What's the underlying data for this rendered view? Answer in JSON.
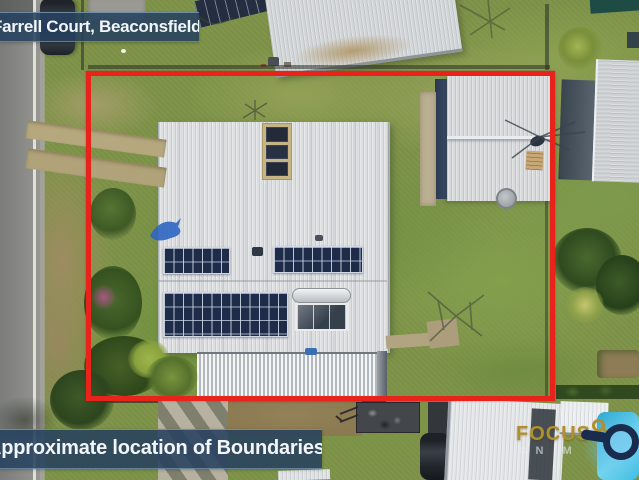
{
  "overlays": {
    "location_banner": {
      "text": "Farrell Court, Beaconsfield"
    },
    "boundary_banner": {
      "text": "Approximate location of Boundaries"
    },
    "boundary_box": {
      "color": "#e8231c"
    }
  },
  "watermark": {
    "brand": "FOCUS",
    "tagline_visible": "ON M",
    "brand_color": "#b0902d",
    "icon": "magnifying-glass-icon",
    "icon_colors": {
      "ring": "#1a2c4e",
      "lens": "#82cdf0",
      "accent": "#b0902d"
    }
  },
  "scene": {
    "type": "aerial-drone-photo",
    "palette": {
      "grass": "#7e9348",
      "road": "#8a8b88",
      "main_roof": "#dcdee0",
      "solar_panels": "#1e2c49",
      "pool": "#3ab4de"
    },
    "features": [
      "road",
      "parked-car",
      "main-house-roof",
      "solar-panel-arrays",
      "solar-hot-water",
      "skylight-strip",
      "patio-roof",
      "garden-shed",
      "clothesline",
      "neighbour-roofs",
      "swimming-pool",
      "trailer",
      "parked-suv",
      "garden-beds",
      "blue-dolphin-ornament",
      "red-boundary-outline"
    ]
  }
}
